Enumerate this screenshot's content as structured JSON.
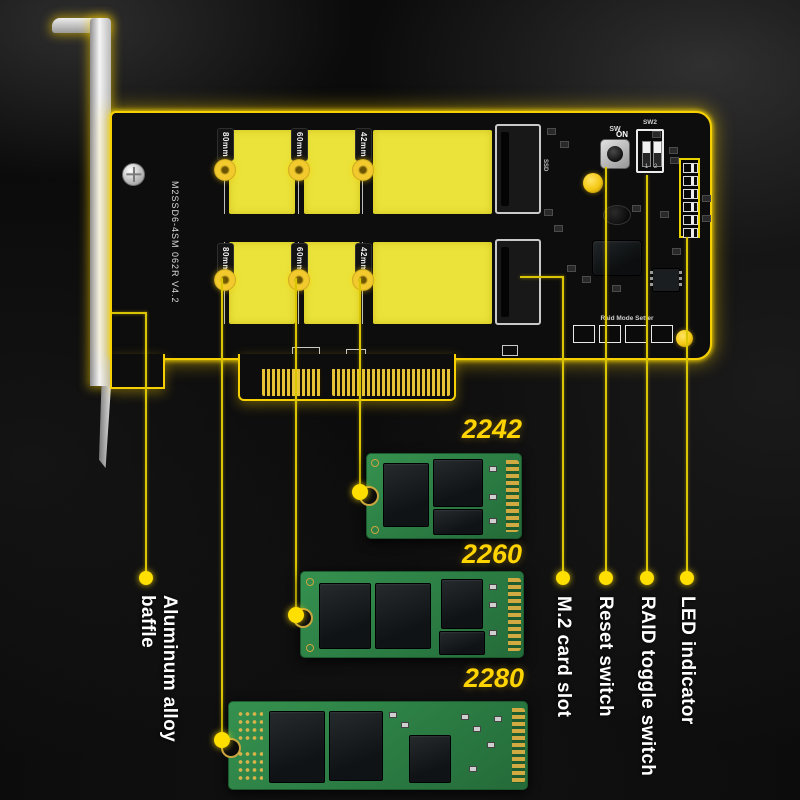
{
  "card": {
    "model_text": "M2SSD6-4SM 062R V4.2",
    "slot_marking": "SSD",
    "reset_marking": "SW",
    "dip_marking": "SW2",
    "dip_on": "ON",
    "dip_numbers": "1 2",
    "raid_setter_label": "Raid Mode Setter",
    "standoff_labels": [
      "80mm",
      "60mm",
      "42mm"
    ]
  },
  "ssds": [
    {
      "size": "2242"
    },
    {
      "size": "2260"
    },
    {
      "size": "2280"
    }
  ],
  "callouts": [
    {
      "label": "Aluminum alloy baffle"
    },
    {
      "label": "M.2 card slot"
    },
    {
      "label": "Reset switch"
    },
    {
      "label": "RAID toggle switch"
    },
    {
      "label": "LED indicator"
    }
  ],
  "colors": {
    "glow_yellow": "#f6d002",
    "line_yellow": "#d9c503",
    "pad_yellow": "#ebe33a",
    "label_yellow": "#ffd400",
    "pcb_green": "#2e8148",
    "text_white": "#ffffff"
  }
}
